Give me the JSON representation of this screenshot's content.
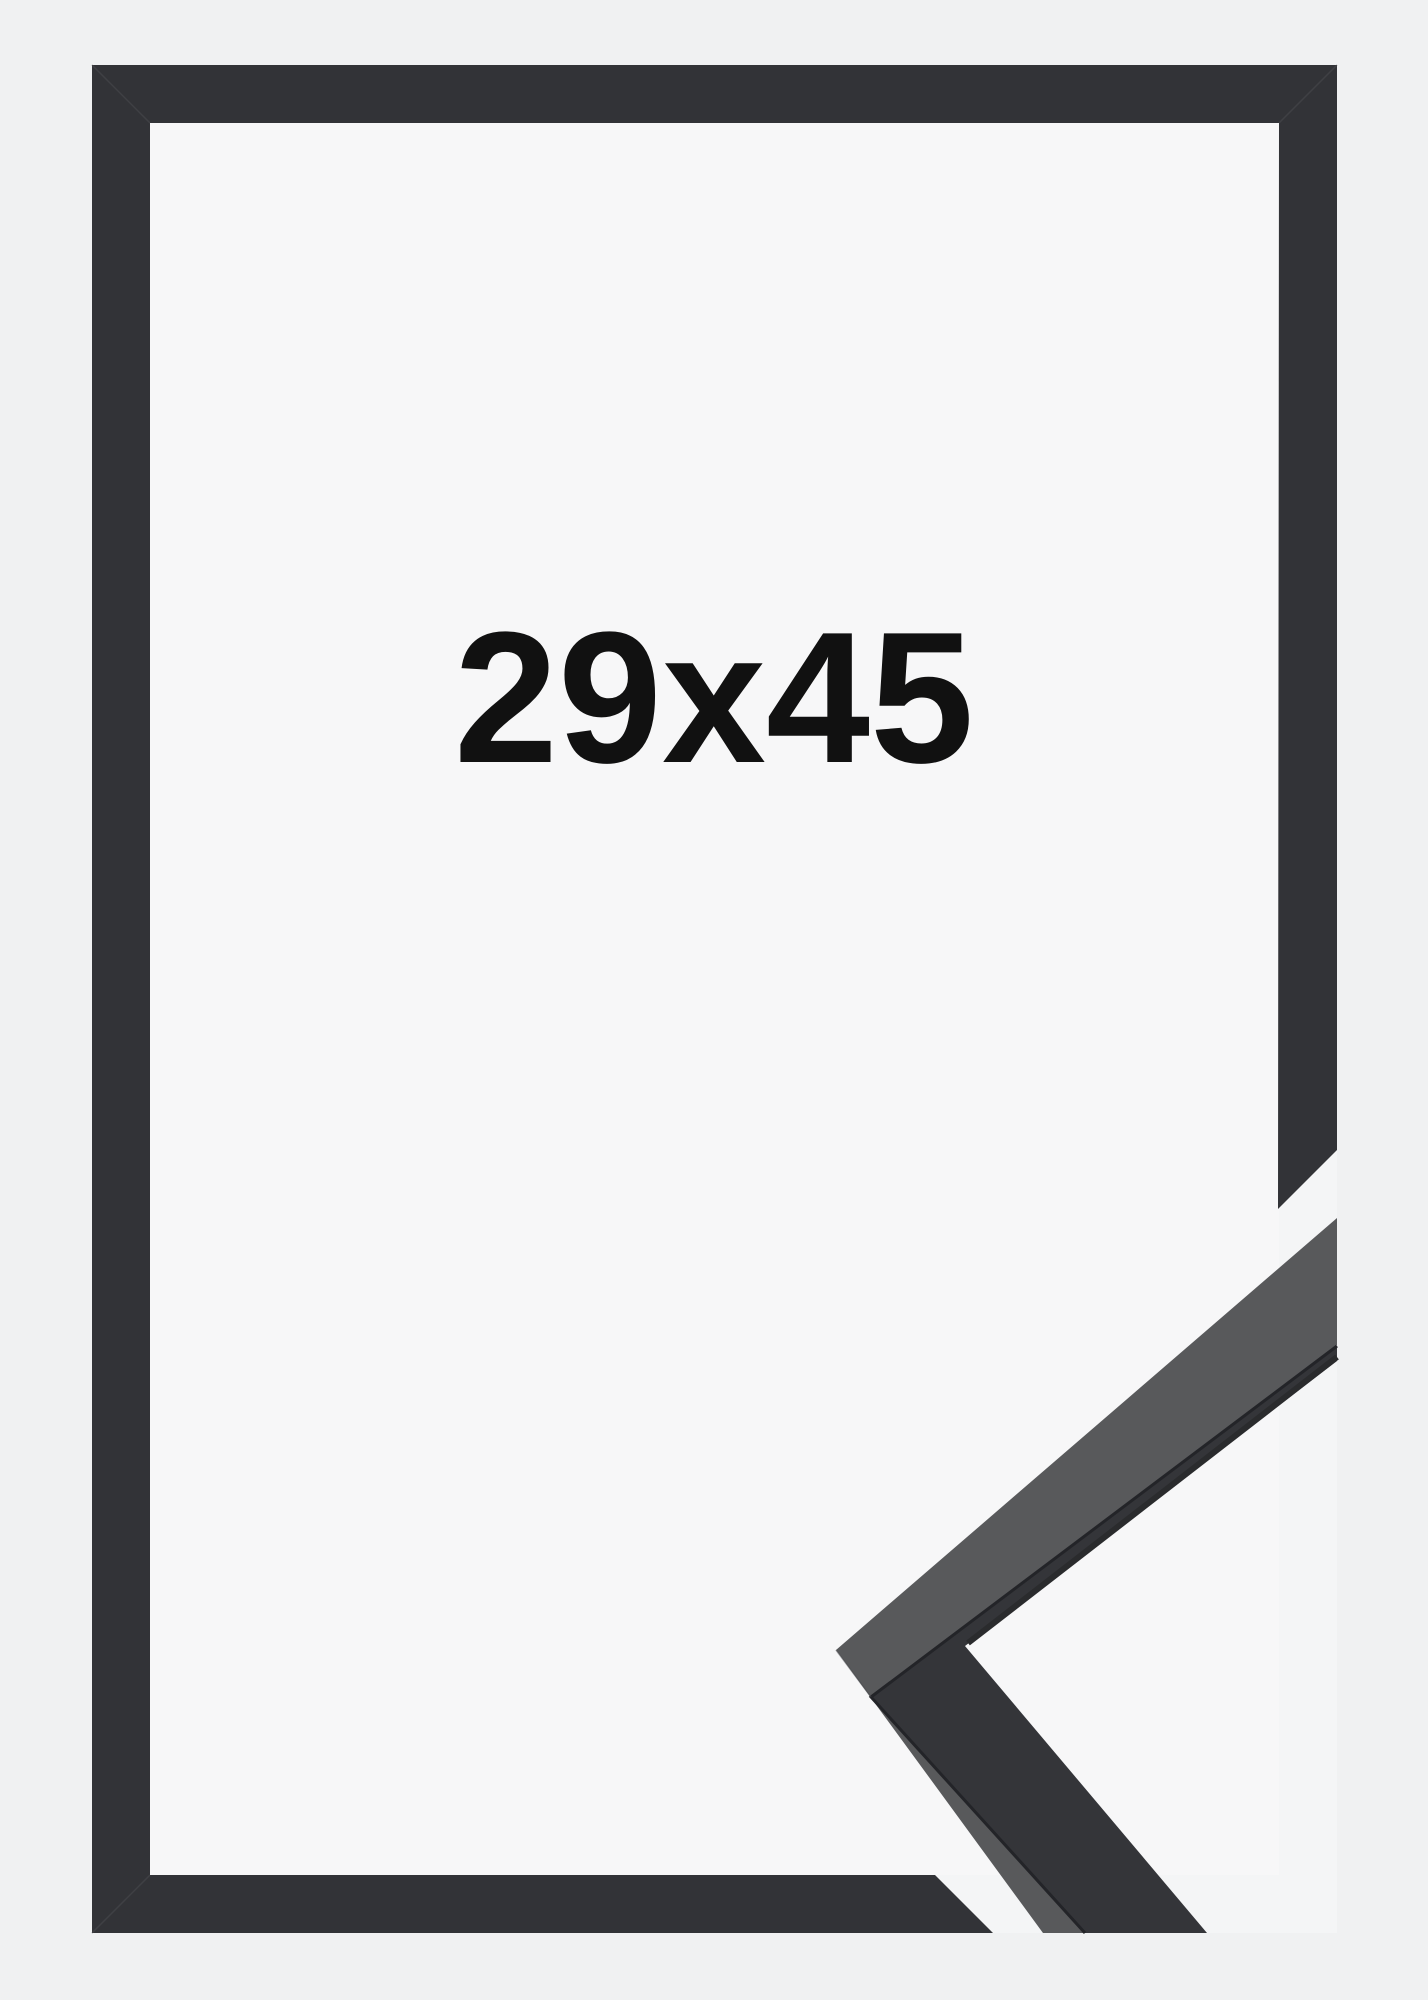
{
  "product_image": {
    "size_label": "29x45"
  },
  "colors": {
    "page_background": "#f0f1f2",
    "photo_background": "#f4f5f6",
    "frame_opening_paper": "#f7f7f8",
    "frame_front": "#323337",
    "sample_front_face": "#58595b",
    "sample_side_face": "#343539",
    "sample_edge_dark": "#2a2b2d",
    "crease": "#232428",
    "miter_seam": "#4a4b4f",
    "label_text": "#111111"
  }
}
